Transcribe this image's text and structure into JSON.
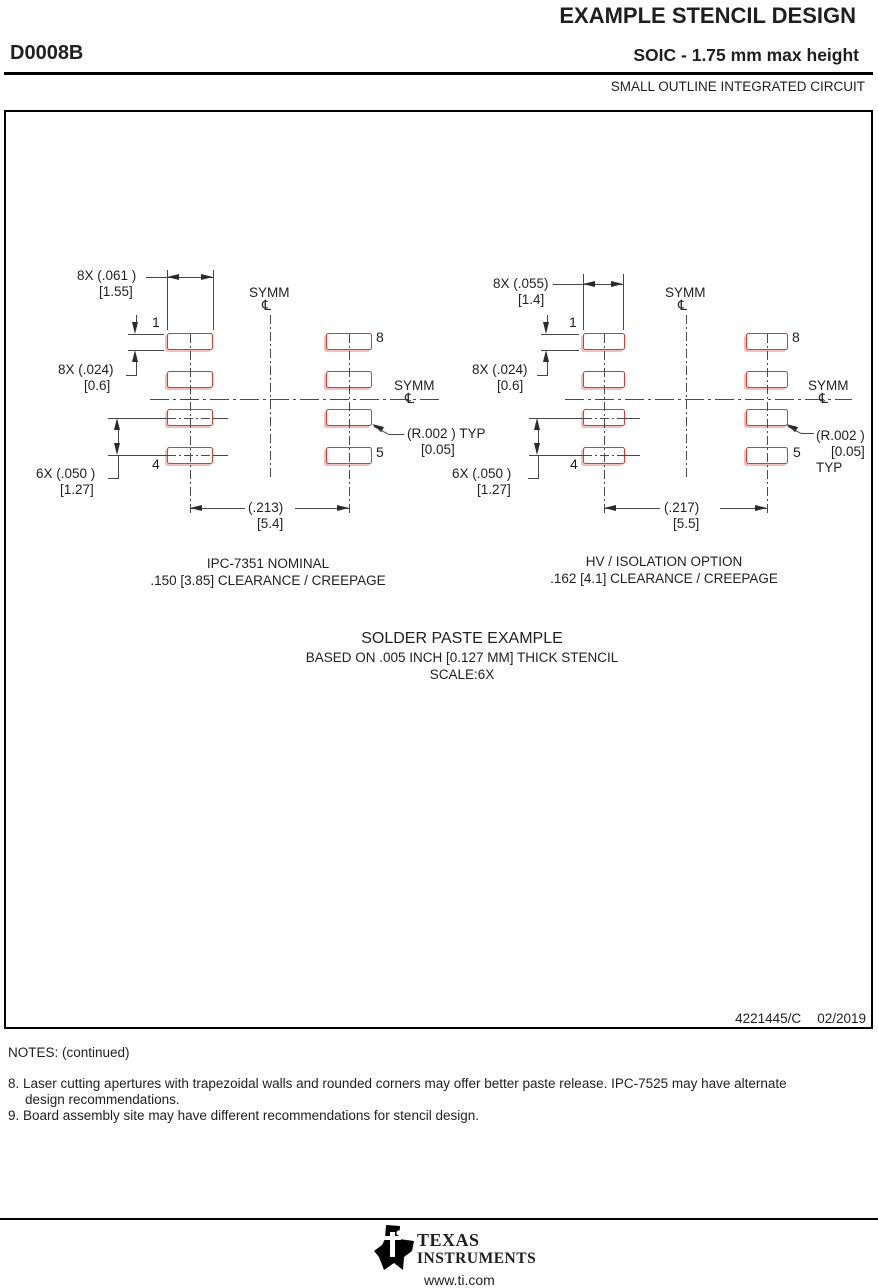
{
  "header": {
    "doc_title": "EXAMPLE STENCIL DESIGN",
    "package_code": "D0008B",
    "package_desc": "SOIC - 1.75 mm max height",
    "package_family": "SMALL OUTLINE INTEGRATED CIRCUIT"
  },
  "symbols": {
    "centerline": "℄"
  },
  "diagrams": {
    "left": {
      "dim_width": "8X (.061 )",
      "dim_width_mm": "[1.55]",
      "dim_pad_height": "8X (.024)",
      "dim_pad_height_mm": "[0.6]",
      "dim_pitch": "6X (.050 )",
      "dim_pitch_mm": "[1.27]",
      "dim_span": "(.213)",
      "dim_span_mm": "[5.4]",
      "radius_note": "(R.002 ) TYP",
      "radius_note_mm": "[0.05]",
      "symm_top": "SYMM",
      "symm_side": "SYMM",
      "pins": {
        "p1": "1",
        "p4": "4",
        "p5": "5",
        "p8": "8"
      },
      "caption_line1": "IPC-7351 NOMINAL",
      "caption_line2": ".150 [3.85] CLEARANCE / CREEPAGE"
    },
    "right": {
      "dim_width": "8X (.055)",
      "dim_width_mm": "[1.4]",
      "dim_pad_height": "8X (.024)",
      "dim_pad_height_mm": "[0.6]",
      "dim_pitch": "6X (.050 )",
      "dim_pitch_mm": "[1.27]",
      "dim_span": "(.217)",
      "dim_span_mm": "[5.5]",
      "radius_note": "(R.002 )",
      "radius_note_mm": "[0.05]",
      "radius_note_typ": "TYP",
      "symm_top": "SYMM",
      "symm_side": "SYMM",
      "pins": {
        "p1": "1",
        "p4": "4",
        "p5": "5",
        "p8": "8"
      },
      "caption_line1": "HV / ISOLATION OPTION",
      "caption_line2": ".162 [4.1] CLEARANCE / CREEPAGE"
    }
  },
  "subtitle_block": {
    "line1": "SOLDER PASTE EXAMPLE",
    "line2": "BASED ON .005 INCH [0.127 MM] THICK STENCIL",
    "line3": "SCALE:6X"
  },
  "title_block": {
    "doc_number": "4221445/C",
    "date": "02/2019"
  },
  "notes": {
    "title": "NOTES: (continued)",
    "note8_line1": "8. Laser cutting apertures with trapezoidal walls and rounded corners may offer better paste release. IPC-7525 may have alternate",
    "note8_line2": "design recommendations.",
    "note9": "9. Board assembly site may have different recommendations for stencil design."
  },
  "footer": {
    "brand_top": "TEXAS",
    "brand_bottom": "INSTRUMENTS",
    "website": "www.ti.com"
  },
  "colors": {
    "pad_stroke": "#e8342c",
    "pad_shadow": "#f6bcbc",
    "line": "#474747"
  }
}
